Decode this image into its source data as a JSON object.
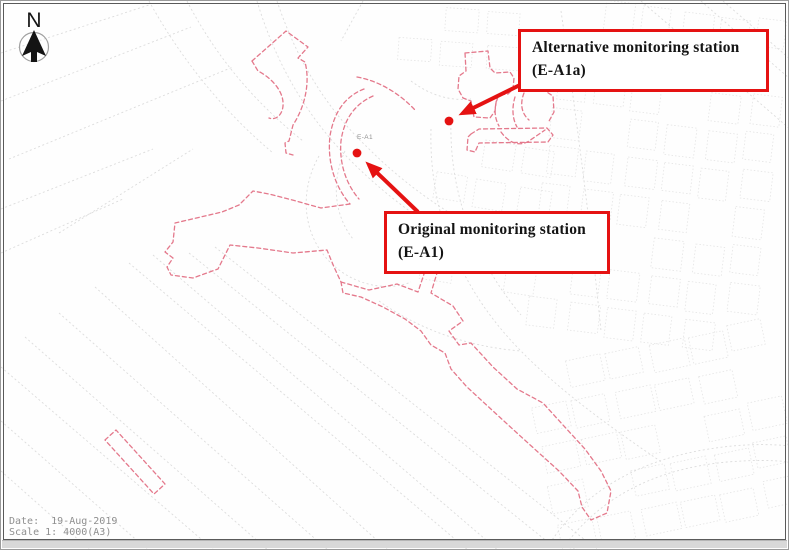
{
  "compass": {
    "label": "N"
  },
  "callouts": {
    "alternative": {
      "line1": "Alternative monitoring station",
      "line2": "(E-A1a)"
    },
    "original": {
      "line1": "Original monitoring station",
      "line2": "(E-A1)"
    }
  },
  "map_labels": {
    "original_station_code": "E-A1"
  },
  "footer": {
    "date": "Date:  19-Aug-2019",
    "scale": "Scale 1: 4000(A3)"
  },
  "colors": {
    "annotation_red": "#e51212",
    "boundary_pink": "#e4798c",
    "linework_gray": "#dcdcdc",
    "linework_gray_light": "#e4e4e4",
    "footer_gray": "#8f8f8f"
  }
}
